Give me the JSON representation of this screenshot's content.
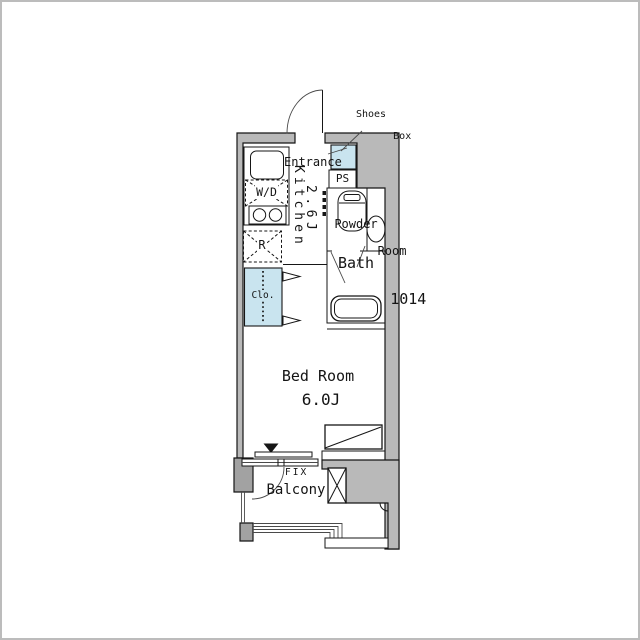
{
  "plan": {
    "entrance": {
      "label": "Entrance"
    },
    "shoes_box": {
      "line1": "Shoes",
      "line2": "Box"
    },
    "ps": {
      "label": "PS"
    },
    "kitchen": {
      "name": "Kitchen",
      "size": "2.6J"
    },
    "fixtures": {
      "washer_dryer": "W/D",
      "refrigerator": "R"
    },
    "closet": {
      "label": "Clo."
    },
    "powder_room": {
      "line1": "Powder",
      "line2": "Room"
    },
    "bath": {
      "name": "Bath",
      "size": "1014"
    },
    "bedroom": {
      "name": "Bed Room",
      "size": "6.0J"
    },
    "window": {
      "fix_label": "FIX"
    },
    "balcony": {
      "label": "Balcony"
    },
    "colors": {
      "background": "#ffffff",
      "frame_border": "#bcbcbc",
      "wall_fill": "#b9b9b9",
      "wall_dark": "#a2a2a2",
      "line": "#161616",
      "fixture_blue": "#c9e4ef",
      "text": "#141414"
    }
  }
}
